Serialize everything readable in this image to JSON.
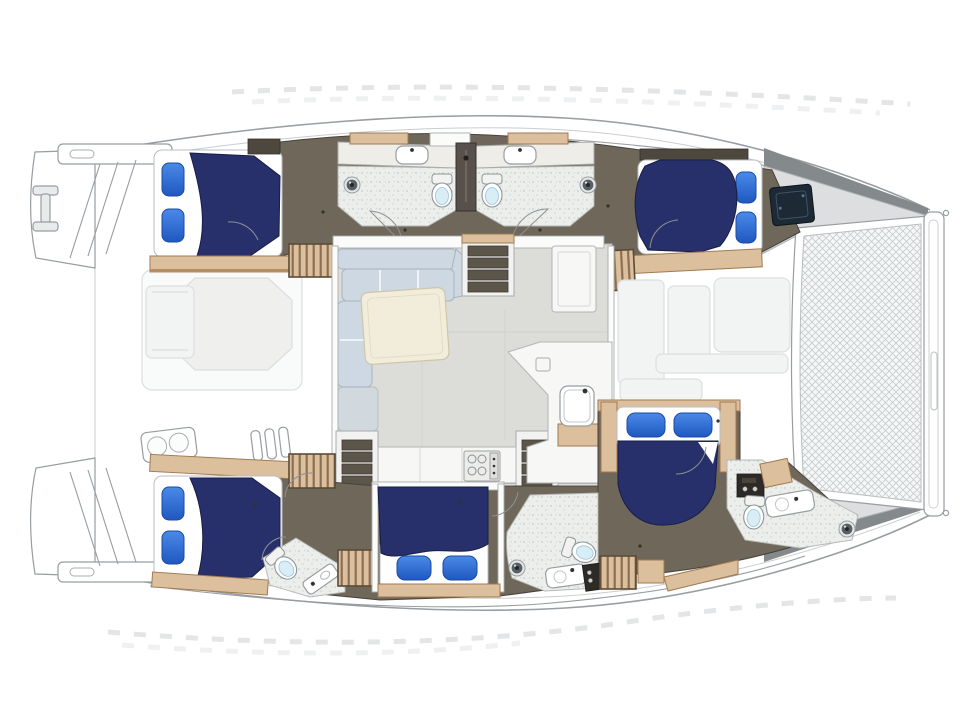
{
  "page": {
    "background": "#ffffff",
    "type": "yacht-interior-deck-plan"
  },
  "palette": {
    "hull-line": "#979da1",
    "hull-line-soft": "#c9cdcf",
    "deck-white": "#ffffff",
    "fade-fill": "#f2f3f3",
    "fade-line": "#dcdee0",
    "floor-dark": "#6f6759",
    "floor-dark-edge": "#47423a",
    "wood": "#dcbf9c",
    "wood-edge": "#a07a52",
    "navy": "#27306b",
    "pillow-light": "#4a8ae8",
    "pillow-deep": "#1f58c0",
    "mattress": "#ffffff",
    "bath-floor": "#eceeec",
    "toilet-seat": "#d9edf7",
    "salon-floor": "#dcddd8",
    "sofa": "#cdd8e3",
    "table": "#f2ecda",
    "counter": "#f7f7f5",
    "stair-tread": "#5c554a",
    "foredeck": "#dcdedf",
    "topsides-dark": "#84898c",
    "hatch-navy": "#1d2935",
    "appliance-dark": "#2e2a25",
    "mesh-line": "#c6cbce"
  },
  "inventory": {
    "vessel": "catamaran",
    "view": "interior floor plan, bow to the right",
    "cabins": 5,
    "double-beds": 5,
    "pillows": 10,
    "bathrooms": 5,
    "toilets": 5,
    "shower-drains": 4,
    "bathroom-sinks": 5,
    "stair-flights": 3,
    "salon": [
      "l-shaped-settee",
      "salon-table",
      "galley-counter",
      "stove",
      "galley-sink",
      "refrigerator"
    ],
    "deck": [
      "bow-trampoline",
      "bow-crossbeam",
      "foredeck",
      "stern-platforms",
      "boarding-steps",
      "stern-cleat",
      "engine-hatch",
      "aft-deck-table",
      "aft-deck-bench",
      "forward-cockpit-seating"
    ]
  }
}
